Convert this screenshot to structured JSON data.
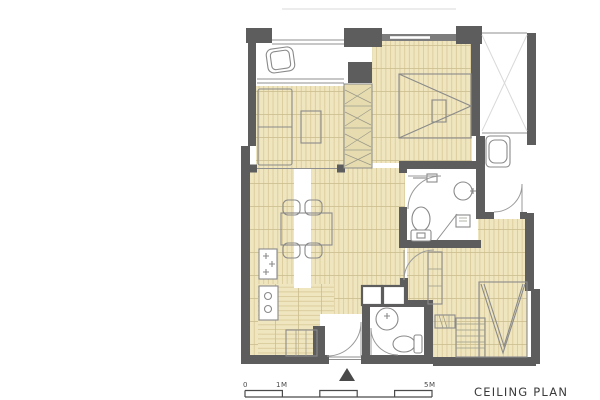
{
  "title": "CEILING PLAN",
  "scale_bar": {
    "label_start": "0",
    "label_mid": "1M",
    "label_end": "5M"
  },
  "colors": {
    "wall": "#5e5d5d",
    "wood_ceiling": "#efe5bf",
    "wood_stripe": "#dbcc9c",
    "wood_joint": "#cbbd8f",
    "furniture_outline": "#8a8a8a",
    "entry_marker": "#4a4a4a",
    "background": "#ffffff"
  },
  "icons": {
    "entry_marker": "solid triangle pointing up at main entrance",
    "lounge_chair": "balcony lounge chair outline",
    "bed_single": "bed in left bedroom",
    "bed_double": "bed with fold lines in master bedroom",
    "bed_v": "bed with V fold lines in lower-right bedroom",
    "wardrobe": "zigzag-hatched closet strip",
    "washing_machine": "rounded square on service ledge",
    "toilet": "toilet bowl with tank",
    "sink_round": "round wash basin",
    "dining_table": "table with four chairs",
    "stove": "cooktop with plus-shaped burners",
    "fridge_cabinets": "two thick-bordered squares",
    "door_swing": "quarter-circle door arc",
    "ceiling_light": "rectangular ceiling fixture"
  }
}
